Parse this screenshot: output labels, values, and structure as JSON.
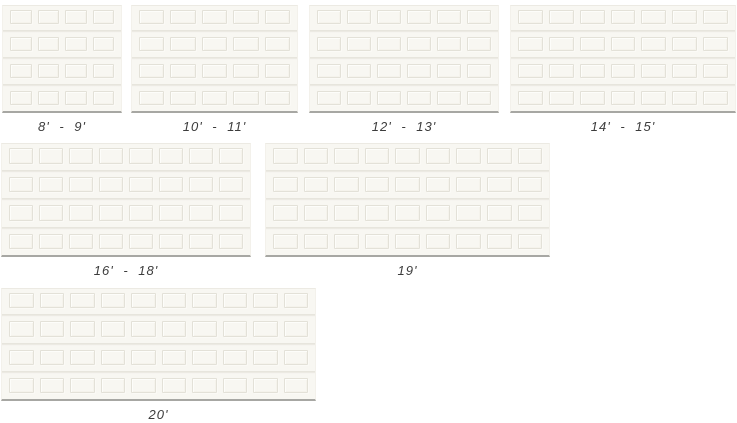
{
  "doors": [
    {
      "label": "8' - 9'",
      "panel_columns": 4,
      "panel_rows": 4
    },
    {
      "label": "10' - 11'",
      "panel_columns": 5,
      "panel_rows": 4
    },
    {
      "label": "12' - 13'",
      "panel_columns": 6,
      "panel_rows": 4
    },
    {
      "label": "14' - 15'",
      "panel_columns": 7,
      "panel_rows": 4
    },
    {
      "label": "16' - 18'",
      "panel_columns": 8,
      "panel_rows": 4
    },
    {
      "label": "19'",
      "panel_columns": 9,
      "panel_rows": 4
    },
    {
      "label": "20'",
      "panel_columns": 10,
      "panel_rows": 4
    }
  ],
  "colors": {
    "background": "#ffffff",
    "door_face": "#f8f7f2",
    "panel_line": "#e3e1d8",
    "panel_highlight": "#fdfdfa",
    "groove_dark": "#e7e5dd",
    "groove_light": "#fbfaf6",
    "door_bottom_edge": "#a7a7a3",
    "label_text": "#3c3c3c"
  }
}
